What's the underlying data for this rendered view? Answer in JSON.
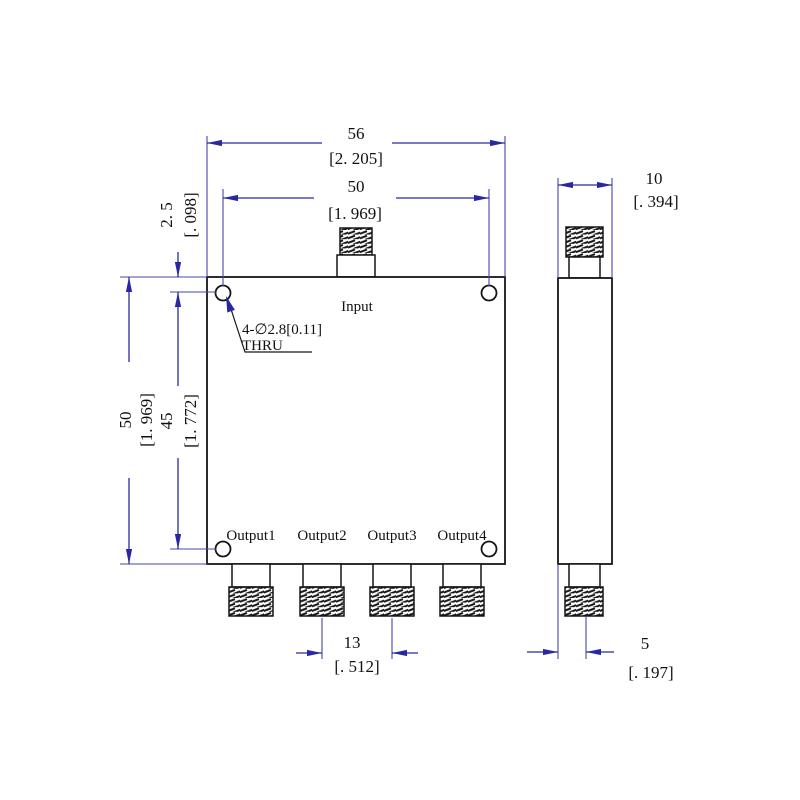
{
  "colors": {
    "dimension_blue": "#2828a2",
    "geometry_black": "#161616",
    "background": "#ffffff"
  },
  "front_view": {
    "input_label": "Input",
    "output_labels": [
      "Output1",
      "Output2",
      "Output3",
      "Output4"
    ],
    "hole_callout": {
      "line1": "4-∅2.8[0.11]",
      "line2": "THRU"
    },
    "dims": {
      "overall_width_mm": "56",
      "overall_width_in": "[2. 205]",
      "hole_span_x_mm": "50",
      "hole_span_x_in": "[1. 969]",
      "overall_height_mm": "50",
      "overall_height_in": "[1. 969]",
      "hole_span_y_mm": "45",
      "hole_span_y_in": "[1. 772]",
      "hole_edge_offset_mm": "2. 5",
      "hole_edge_offset_in": "[. 098]",
      "output_pitch_mm": "13",
      "output_pitch_in": "[. 512]"
    }
  },
  "side_view": {
    "dims": {
      "depth_mm": "10",
      "depth_in": "[. 394]",
      "connector_offset_mm": "5",
      "connector_offset_in": "[. 197]"
    }
  }
}
